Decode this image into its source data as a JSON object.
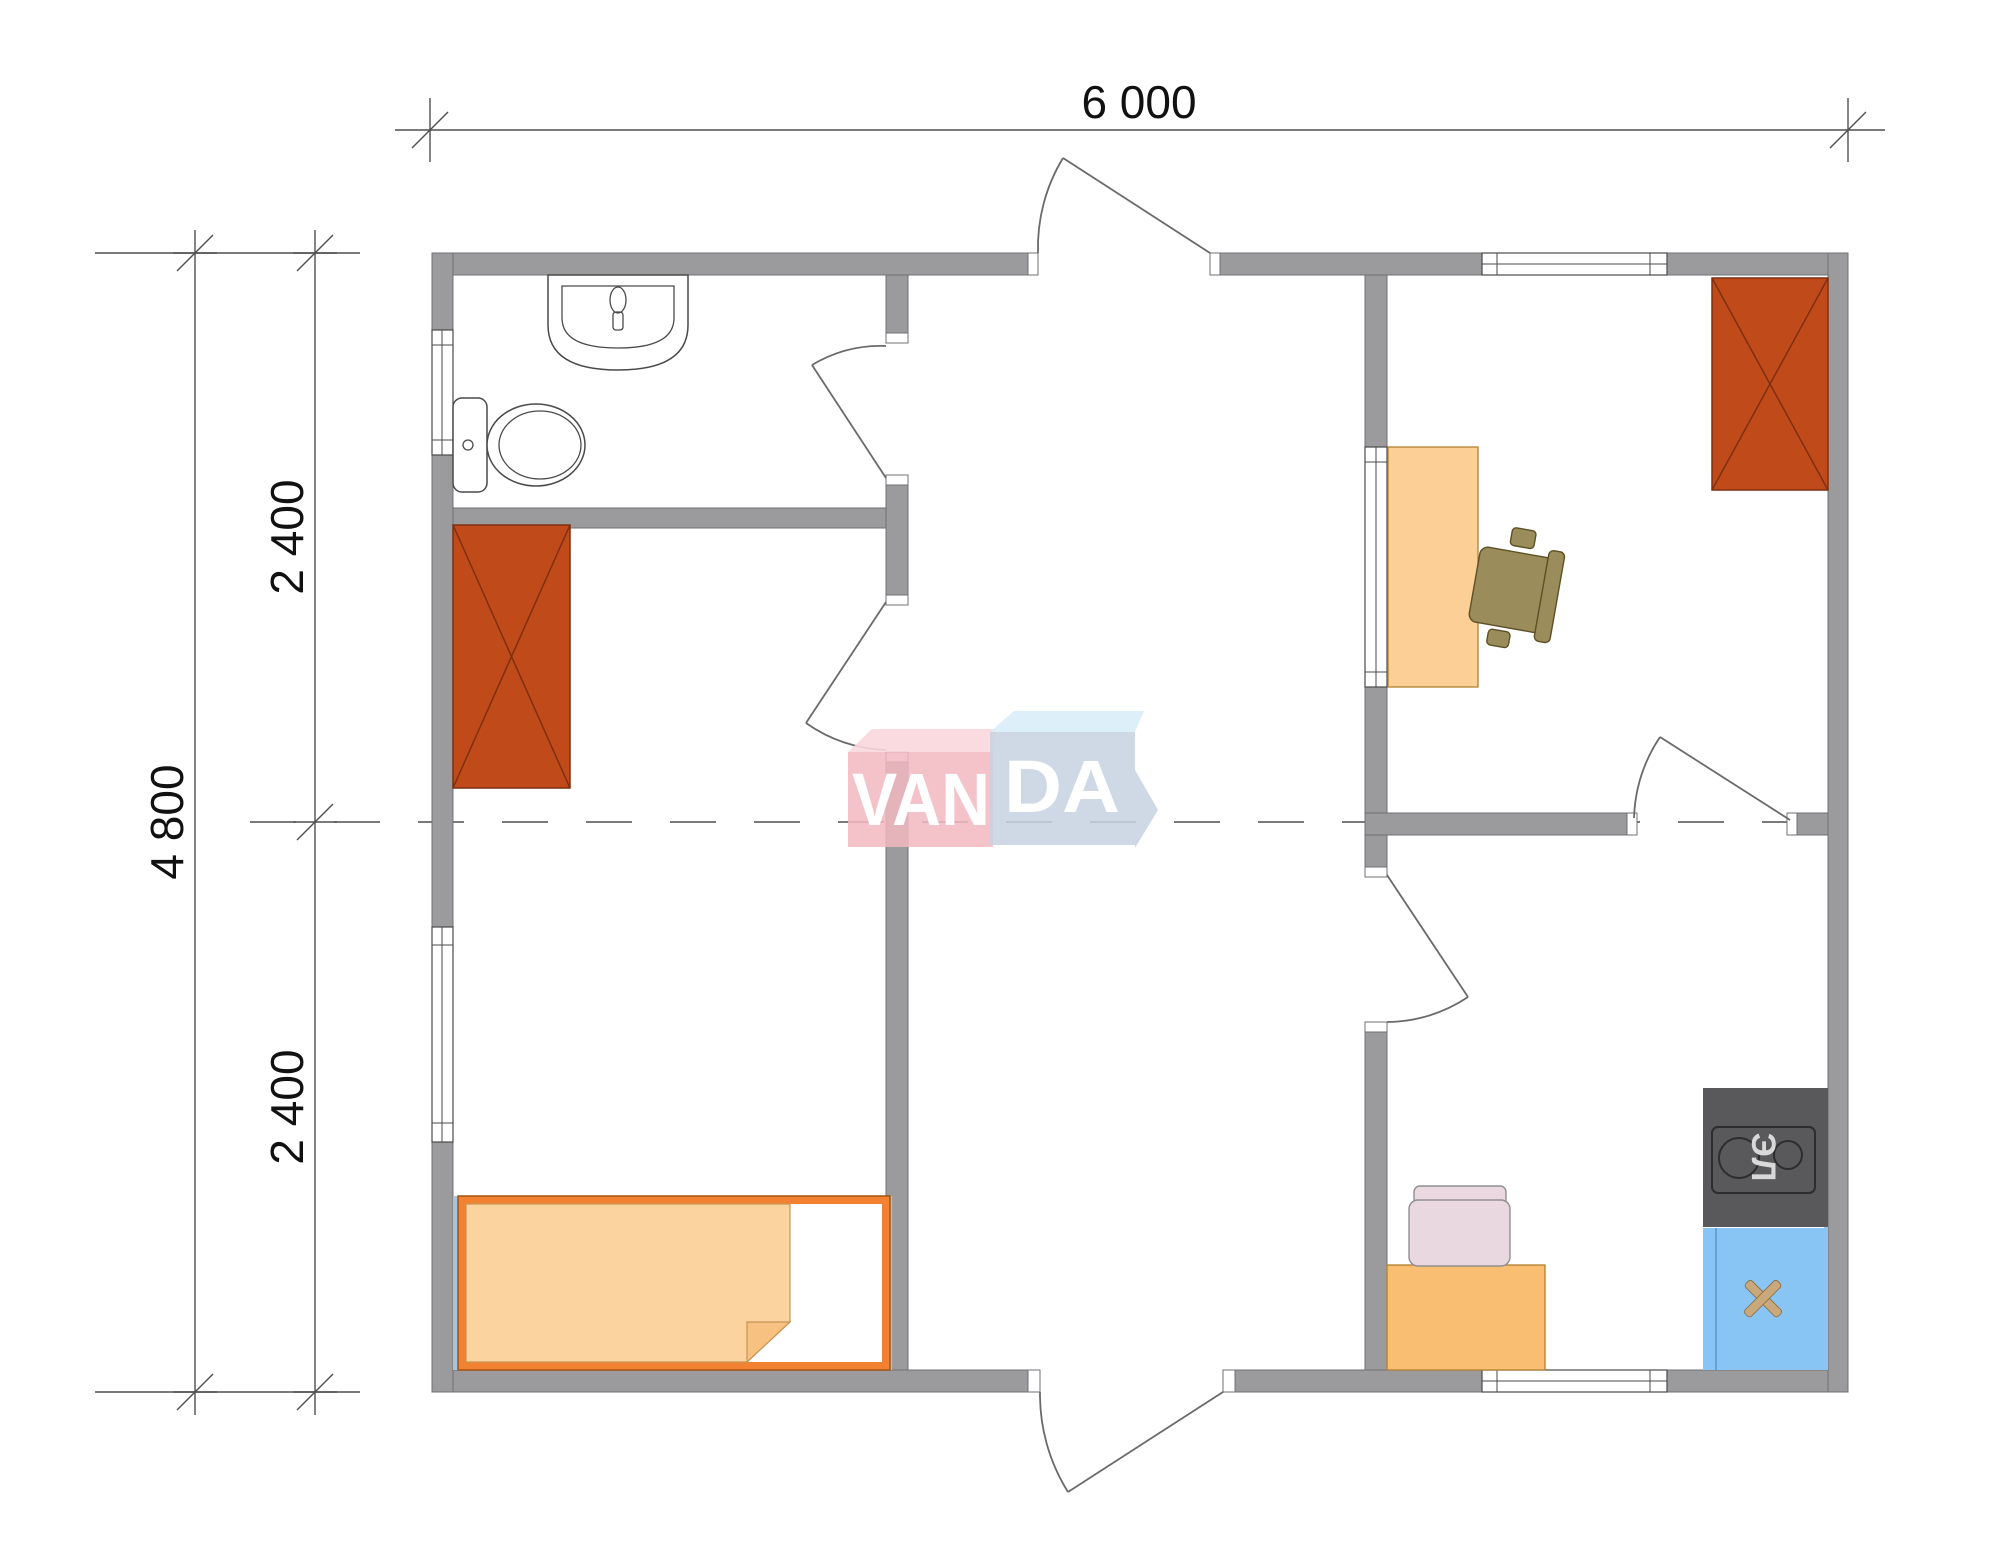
{
  "plan": {
    "type": "floor-plan",
    "dimensions": {
      "width_label": "6 000",
      "height_label": "4 800",
      "upper_label": "2 400",
      "lower_label": "2 400"
    },
    "watermark": {
      "left": "VAN",
      "right": "DA"
    },
    "labels": {
      "stove": "ЭЛ"
    }
  },
  "colors": {
    "wall": "#9B9B9D",
    "wall_line": "#707174",
    "line": "#4A4A4A",
    "door": "#6A6A6A",
    "dim": "#4F4F4F",
    "shade": "#A9C3D9",
    "wardrobe": "#C14A1B",
    "wardrobe_line": "#7E2F10",
    "bed_frame": "#F28232",
    "bed_line": "#A35312",
    "mattress": "#FBD39E",
    "mattress_line": "#C79552",
    "fold": "#F6C181",
    "desk": "#FCCF97",
    "desk_line": "#B0812F",
    "table": "#F9BE72",
    "chair_olive": "#9B8C5C",
    "chair_olive_line": "#5E5026",
    "chair_pink": "#E9D8DF",
    "chair_pink_line": "#8F8F8F",
    "stove": "#59595B",
    "stove_line": "#2D2D2D",
    "stove_text": "#D8D8D8",
    "sink": "#88C4F4",
    "sink_line": "#5FA3D8",
    "tap": "#C9A87C",
    "logo_pink": "#F2B9C1",
    "logo_pink_top": "#F9D7DC",
    "logo_blue": "#C7D2E2",
    "logo_blue_top": "#D9EEFA",
    "logo_text": "#FFFFFF"
  }
}
